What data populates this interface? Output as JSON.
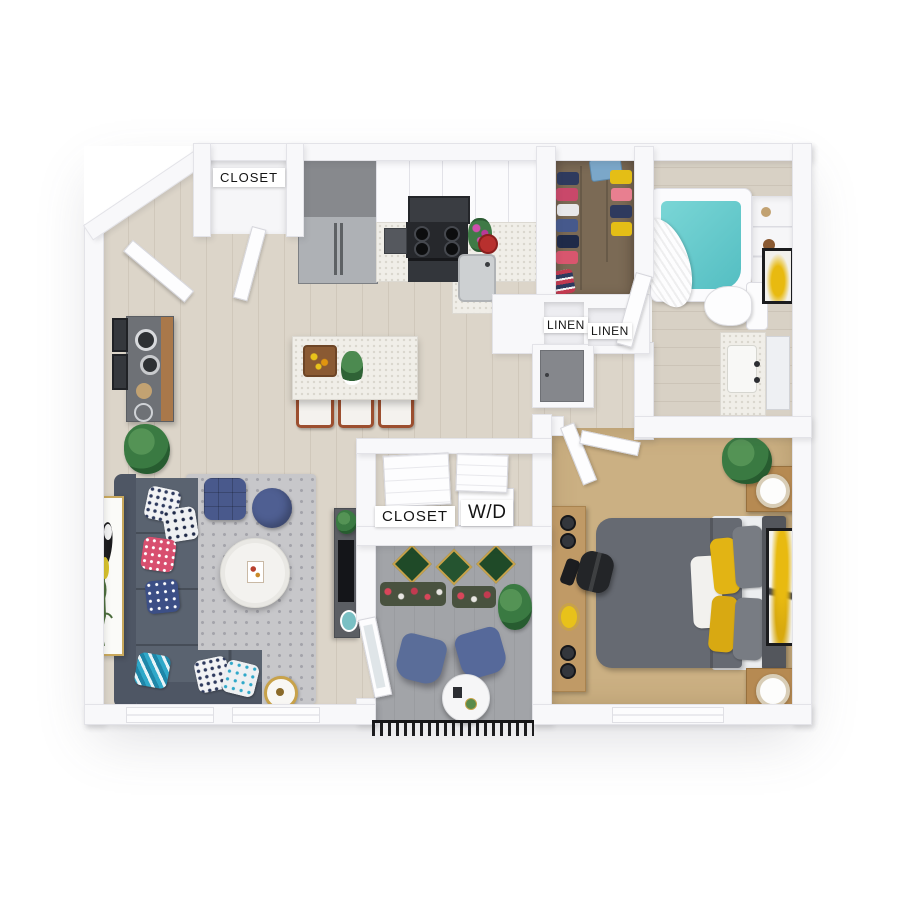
{
  "labels": {
    "entry_closet": "CLOSET",
    "linen_left": "LINEN",
    "linen_right": "LINEN",
    "laundry_closet": "CLOSET",
    "washer_dryer": "W/D"
  },
  "palette": {
    "wall": "#f8f8fa",
    "wood": "#dcd5c9",
    "bath_floor": "#d8d1c5",
    "carpet": "#cbb083",
    "balcony_floor": "#a2a4a8",
    "closet_floor": "#7b6a55",
    "tub_water": "#54bec2",
    "sofa": "#5a6370",
    "sofa_back": "#4e5664",
    "rug": "#c7c7ca",
    "navy": "#49598c",
    "pink": "#d84f6f",
    "teal": "#2fa8c9",
    "yellow": "#e2b414",
    "bed": "#666a72",
    "door_gray": "#85878c",
    "wood_furniture": "#b68a52",
    "railing": "#1c1c1e",
    "plant": "#3a7a42",
    "label_bg": "#ffffff",
    "label_text": "#141414"
  }
}
